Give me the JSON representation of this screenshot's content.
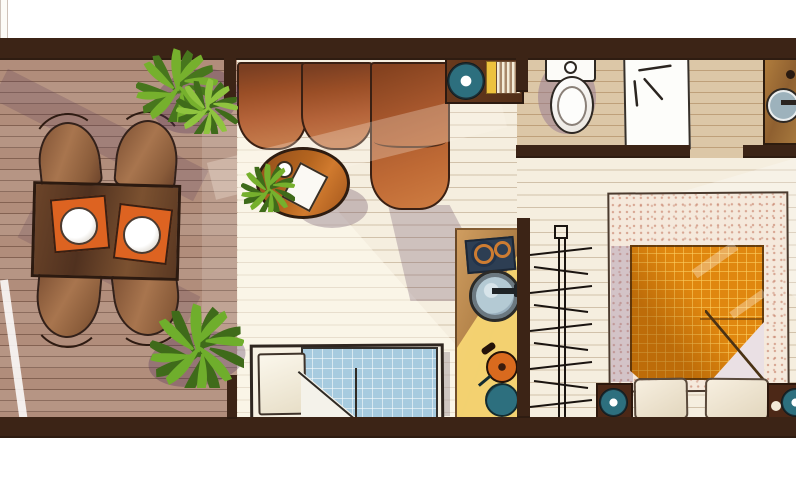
{
  "scene": {
    "type": "apartment floor plan, hand-drawn top-down illustration",
    "canvas": {
      "width": 796,
      "height": 480,
      "background": "#ffffff"
    },
    "rooms": [
      {
        "name": "deck",
        "furniture": [
          "dining-table",
          "placemat (2)",
          "plate (2)",
          "wooden chair (4)",
          "potted plant (2)"
        ]
      },
      {
        "name": "living-room",
        "furniture": [
          "sectional-sofa",
          "coffee-table",
          "table-plant",
          "white book",
          "cup",
          "side-table",
          "teal speaker",
          "yellow item",
          "striped vent",
          "single bed",
          "white pillow",
          "blue checked blanket"
        ]
      },
      {
        "name": "kitchenette-column",
        "furniture": [
          "cooktop with 2 burners",
          "round washer-drum sink with handle",
          "orange frying pan",
          "teal frying pan"
        ]
      },
      {
        "name": "bathroom",
        "furniture": [
          "toilet",
          "white shower mat",
          "wood vanity counter",
          "round sink with faucet"
        ]
      },
      {
        "name": "bedroom",
        "furniture": [
          "speckled bed platform",
          "orange grid blanket with folded corner",
          "pillow (2)",
          "nightstand (2)",
          "teal speaker (2)",
          "black drying rack"
        ]
      }
    ],
    "openings": [
      "glass slider between deck and living room",
      "door gap living-bathroom",
      "door gap living-bedroom",
      "door gap bathroom-bedroom"
    ]
  },
  "palette": {
    "wall": "#3c2416",
    "deck": "#b18d7b",
    "cream": "#f5eedf",
    "tan": "#dcc7a7",
    "orange": "#dd6321",
    "teal": "#2d6f7e",
    "navy": "#2d3e53",
    "yellow_item": "#edc23e",
    "blue": "#a7cbdf",
    "blanket": "#e0870f",
    "platform": "#f5e9dc",
    "green1": "#76b02d",
    "green2": "#47761d",
    "sofa_mid": "#a85a2c",
    "lavender_shadow": "#b5a3c0",
    "white": "#ffffff"
  }
}
